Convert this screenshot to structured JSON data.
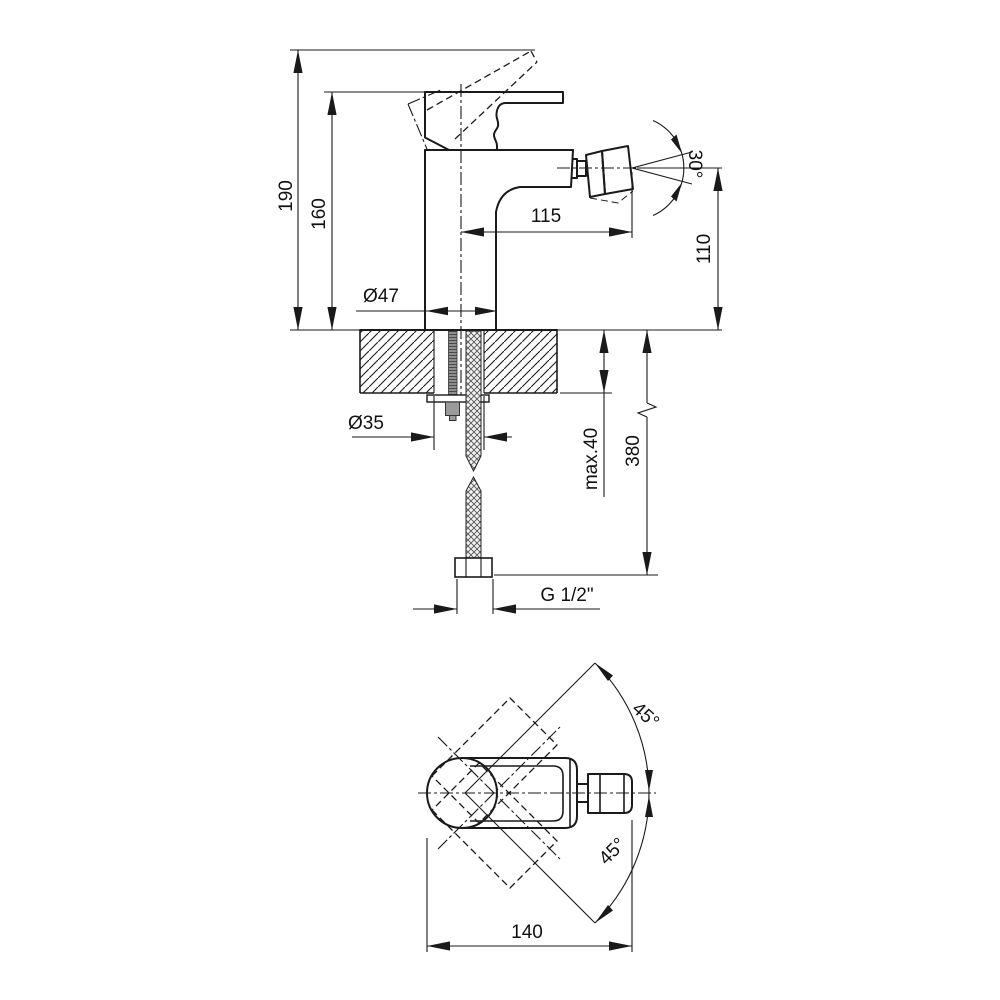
{
  "title": "Bidet mixer technical drawing",
  "colors": {
    "line": "#1a1a1a",
    "background": "#ffffff",
    "rod_fill": "#8f8f8f",
    "nut_fill": "#9a9a9a"
  },
  "front_view": {
    "total_height": "190",
    "height_to_body": "160",
    "spout_reach": "115",
    "spout_height": "110",
    "aerator_angle": "30°",
    "body_diameter": "Ø47",
    "mount_hole_diameter": "Ø35",
    "deck_thickness": "max.40",
    "hose_length": "380",
    "thread_size": "G 1/2\""
  },
  "top_view": {
    "handle_swing_upper": "45°",
    "handle_swing_lower": "45°",
    "overall_length": "140"
  }
}
